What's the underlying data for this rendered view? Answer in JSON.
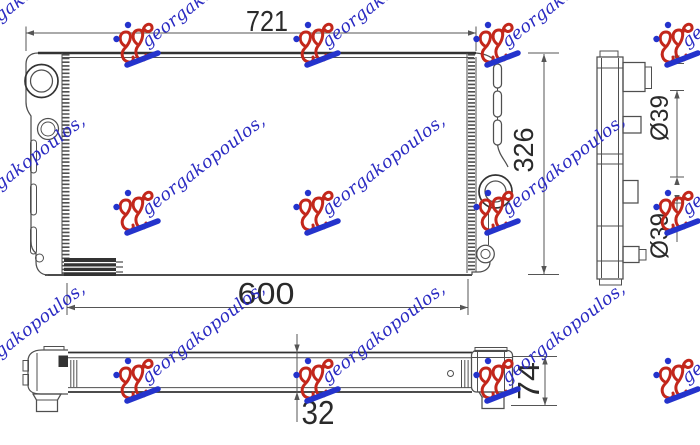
{
  "background": "#ffffff",
  "drawing": {
    "line_color": "#4f4f4f",
    "edge_color": "#333333",
    "dim_line_color": "#555555",
    "dim_text_color": "#2a2a2a",
    "front_view": {
      "overall_width": "721",
      "overall_height": "326",
      "core_width": "600"
    },
    "side_view": {
      "upper_pipe_diameter": "Ø39",
      "lower_pipe_diameter": "Ø39"
    },
    "bottom_view": {
      "core_depth": "32",
      "overall_depth": "74"
    }
  },
  "watermark": {
    "text": "georgakopoulos,",
    "text_color": "#2a2ac2",
    "logo_color": "#c3271b",
    "accent_color": "#2433cc"
  }
}
